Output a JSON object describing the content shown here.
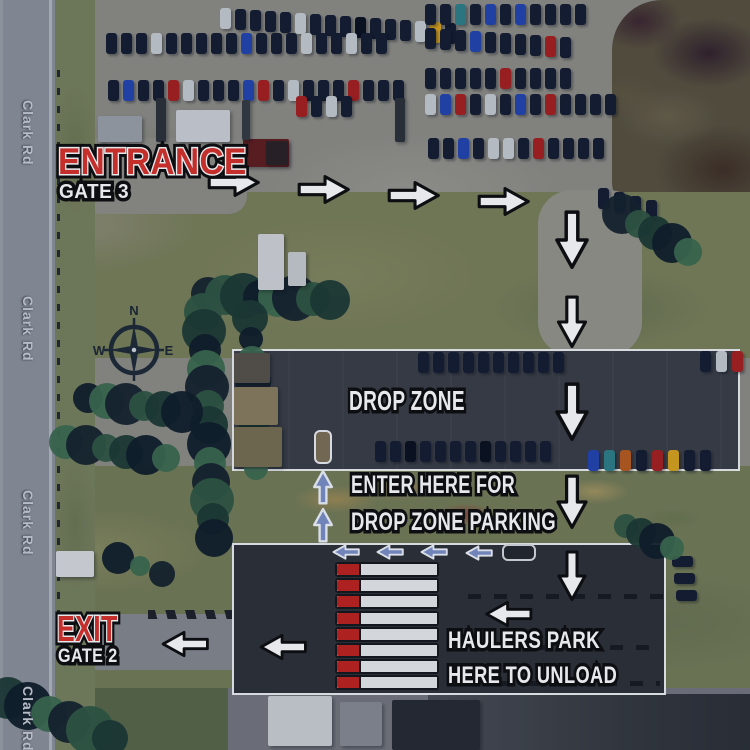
{
  "title": "Aerial event parking map with entrance, drop zone, haulers parking and exit routes",
  "colors": {
    "label_red": "#d8312b",
    "label_white": "#ffffff",
    "label_outline": "#0d0d0d",
    "arrow_white": "#ffffff",
    "arrow_outline": "#0d0d0d",
    "arrow_blue": "#7c90c8",
    "arrow_blue_outline": "#f0f4fb",
    "zone_border": "#eef0f2",
    "truck_cab_red": "#c0221f",
    "truck_trailer": "#e9ecee"
  },
  "labels": {
    "entrance": "ENTRANCE",
    "entrance_gate": "GATE 3",
    "exit": "EXIT",
    "exit_gate": "GATE 2",
    "drop_zone": "DROP ZONE",
    "enter_line1": "ENTER HERE FOR",
    "enter_line2": "DROP ZONE PARKING",
    "haulers_line1": "HAULERS PARK",
    "haulers_line2": "HERE TO UNLOAD",
    "road_name": "Clark Rd",
    "compass": {
      "n": "N",
      "e": "E",
      "s": "S",
      "w": "W"
    }
  },
  "arrows": {
    "white": [
      {
        "dir": "right",
        "x": 205,
        "y": 167,
        "w": 58,
        "h": 31
      },
      {
        "dir": "right",
        "x": 295,
        "y": 174,
        "w": 58,
        "h": 31
      },
      {
        "dir": "right",
        "x": 385,
        "y": 180,
        "w": 58,
        "h": 31
      },
      {
        "dir": "right",
        "x": 475,
        "y": 186,
        "w": 58,
        "h": 31
      },
      {
        "dir": "down",
        "x": 551,
        "y": 211,
        "w": 42,
        "h": 58
      },
      {
        "dir": "down",
        "x": 551,
        "y": 296,
        "w": 42,
        "h": 52
      },
      {
        "dir": "down",
        "x": 551,
        "y": 383,
        "w": 42,
        "h": 58
      },
      {
        "dir": "down",
        "x": 551,
        "y": 475,
        "w": 42,
        "h": 54
      },
      {
        "dir": "down",
        "x": 551,
        "y": 551,
        "w": 42,
        "h": 50
      },
      {
        "dir": "left",
        "x": 481,
        "y": 600,
        "w": 55,
        "h": 28
      },
      {
        "dir": "left",
        "x": 255,
        "y": 633,
        "w": 56,
        "h": 28
      },
      {
        "dir": "left",
        "x": 156,
        "y": 630,
        "w": 58,
        "h": 28
      }
    ],
    "blue": [
      {
        "dir": "up",
        "x": 312,
        "y": 470,
        "w": 22,
        "h": 34
      },
      {
        "dir": "up",
        "x": 312,
        "y": 508,
        "w": 22,
        "h": 34
      },
      {
        "dir": "left",
        "x": 331,
        "y": 544,
        "w": 30,
        "h": 16
      },
      {
        "dir": "left",
        "x": 375,
        "y": 544,
        "w": 30,
        "h": 16
      },
      {
        "dir": "left",
        "x": 419,
        "y": 544,
        "w": 30,
        "h": 16
      },
      {
        "dir": "left",
        "x": 464,
        "y": 545,
        "w": 30,
        "h": 16
      }
    ]
  },
  "haulers_trucks": {
    "count": 8,
    "x": 335,
    "y": 562,
    "step": 16.2,
    "w": 104,
    "h": 15,
    "cab_w": 24,
    "cab_color": "#c0221f",
    "trailer_color": "#e9ecee",
    "border": "#15171b"
  },
  "vehicles": [
    {
      "kind": "car-top-view",
      "x": 314,
      "y": 430,
      "w": 18,
      "h": 34,
      "body": "#7c7056",
      "outline": "#eceff2"
    },
    {
      "kind": "car-side-dark",
      "x": 502,
      "y": 544,
      "w": 34,
      "h": 17,
      "body": "#23262c",
      "outline": "#d8dbde"
    }
  ],
  "scenery": {
    "car_palette": {
      "d": "#131c30",
      "k": "#0a101e",
      "w": "#c6ccd2",
      "r": "#a8201f",
      "b": "#2244b0",
      "y": "#d9a31c",
      "g": "#5d6a77",
      "t": "#2e7f8a",
      "o": "#b85c1e"
    },
    "car_rows": [
      {
        "x": 220,
        "y": 8,
        "dx": 15,
        "dy": 1,
        "o": "v",
        "s": "wddddwdddkdddwyd"
      },
      {
        "x": 106,
        "y": 33,
        "dx": 15,
        "dy": 0,
        "o": "v",
        "s": "dddwdddddbdddwddwdd"
      },
      {
        "x": 425,
        "y": 4,
        "dx": 15,
        "dy": 0,
        "o": "v",
        "s": "ddtdbdbdddd"
      },
      {
        "x": 425,
        "y": 28,
        "dx": 15,
        "dy": 1,
        "o": "v",
        "s": "dddbddddrd"
      },
      {
        "x": 108,
        "y": 80,
        "dx": 15,
        "dy": 0,
        "o": "v",
        "s": "dbddrwdddbrdwdddrddd"
      },
      {
        "x": 296,
        "y": 96,
        "dx": 15,
        "dy": 0,
        "o": "v",
        "s": "rdwd"
      },
      {
        "x": 425,
        "y": 68,
        "dx": 15,
        "dy": 0,
        "o": "v",
        "s": "dddddrdddd"
      },
      {
        "x": 425,
        "y": 94,
        "dx": 15,
        "dy": 0,
        "o": "v",
        "s": "wbrdwdbdrdddd"
      },
      {
        "x": 428,
        "y": 138,
        "dx": 15,
        "dy": 0,
        "o": "v",
        "s": "ddbdwwdrdddd"
      },
      {
        "x": 598,
        "y": 188,
        "dx": 16,
        "dy": 4,
        "o": "v",
        "s": "dddd"
      },
      {
        "x": 418,
        "y": 352,
        "dx": 15,
        "dy": 0,
        "o": "v",
        "s": "dddddddddd"
      },
      {
        "x": 700,
        "y": 351,
        "dx": 16,
        "dy": 0,
        "o": "v",
        "s": "dwr"
      },
      {
        "x": 375,
        "y": 441,
        "dx": 15,
        "dy": 0,
        "o": "v",
        "s": "ddkddddkdddd"
      },
      {
        "x": 588,
        "y": 450,
        "dx": 16,
        "dy": 0,
        "o": "v",
        "s": "btodrydd"
      },
      {
        "x": 672,
        "y": 556,
        "dx": 2,
        "dy": 17,
        "o": "h",
        "s": "ddd"
      }
    ],
    "tree_colors": [
      "#14222c",
      "#2f5743",
      "#1c3a34",
      "#0f1e29",
      "#3c6c4f"
    ],
    "tree_segments": [
      {
        "x1": 208,
        "y1": 294,
        "x2": 330,
        "y2": 300,
        "r": 17,
        "n": 8
      },
      {
        "x1": 203,
        "y1": 312,
        "x2": 214,
        "y2": 538,
        "r": 16,
        "n": 13
      },
      {
        "x1": 250,
        "y1": 318,
        "x2": 256,
        "y2": 468,
        "r": 12,
        "n": 8
      },
      {
        "x1": 88,
        "y1": 398,
        "x2": 182,
        "y2": 412,
        "r": 15,
        "n": 6
      },
      {
        "x1": 66,
        "y1": 442,
        "x2": 166,
        "y2": 458,
        "r": 14,
        "n": 6
      },
      {
        "x1": 622,
        "y1": 214,
        "x2": 688,
        "y2": 252,
        "r": 14,
        "n": 5
      },
      {
        "x1": 626,
        "y1": 526,
        "x2": 672,
        "y2": 548,
        "r": 12,
        "n": 4
      },
      {
        "x1": 8,
        "y1": 698,
        "x2": 110,
        "y2": 738,
        "r": 18,
        "n": 6
      },
      {
        "x1": 118,
        "y1": 558,
        "x2": 162,
        "y2": 574,
        "r": 10,
        "n": 3
      }
    ],
    "buildings": [
      {
        "x": 176,
        "y": 110,
        "w": 54,
        "h": 32,
        "c": "#ccd1d7"
      },
      {
        "x": 98,
        "y": 116,
        "w": 44,
        "h": 26,
        "c": "#9ba1a9"
      },
      {
        "x": 243,
        "y": 139,
        "w": 46,
        "h": 28,
        "c": "#5f1d1d"
      },
      {
        "x": 266,
        "y": 141,
        "w": 22,
        "h": 24,
        "c": "#2a2125"
      },
      {
        "x": 156,
        "y": 98,
        "w": 10,
        "h": 44,
        "c": "#2c3138"
      },
      {
        "x": 242,
        "y": 100,
        "w": 8,
        "h": 40,
        "c": "#343a41"
      },
      {
        "x": 395,
        "y": 98,
        "w": 10,
        "h": 44,
        "c": "#2c3138"
      },
      {
        "x": 234,
        "y": 353,
        "w": 36,
        "h": 30,
        "c": "#575249"
      },
      {
        "x": 234,
        "y": 387,
        "w": 44,
        "h": 38,
        "c": "#8a7c5e"
      },
      {
        "x": 234,
        "y": 427,
        "w": 48,
        "h": 40,
        "c": "#786f52"
      },
      {
        "x": 268,
        "y": 696,
        "w": 64,
        "h": 50,
        "c": "#ccd1d5"
      },
      {
        "x": 340,
        "y": 702,
        "w": 42,
        "h": 44,
        "c": "#878b92"
      },
      {
        "x": 392,
        "y": 700,
        "w": 88,
        "h": 50,
        "c": "#262a32"
      },
      {
        "x": 56,
        "y": 551,
        "w": 38,
        "h": 26,
        "c": "#d8dbde"
      },
      {
        "x": 258,
        "y": 234,
        "w": 26,
        "h": 56,
        "c": "#d2d5d8"
      },
      {
        "x": 288,
        "y": 252,
        "w": 18,
        "h": 34,
        "c": "#c8ccd0"
      }
    ]
  }
}
